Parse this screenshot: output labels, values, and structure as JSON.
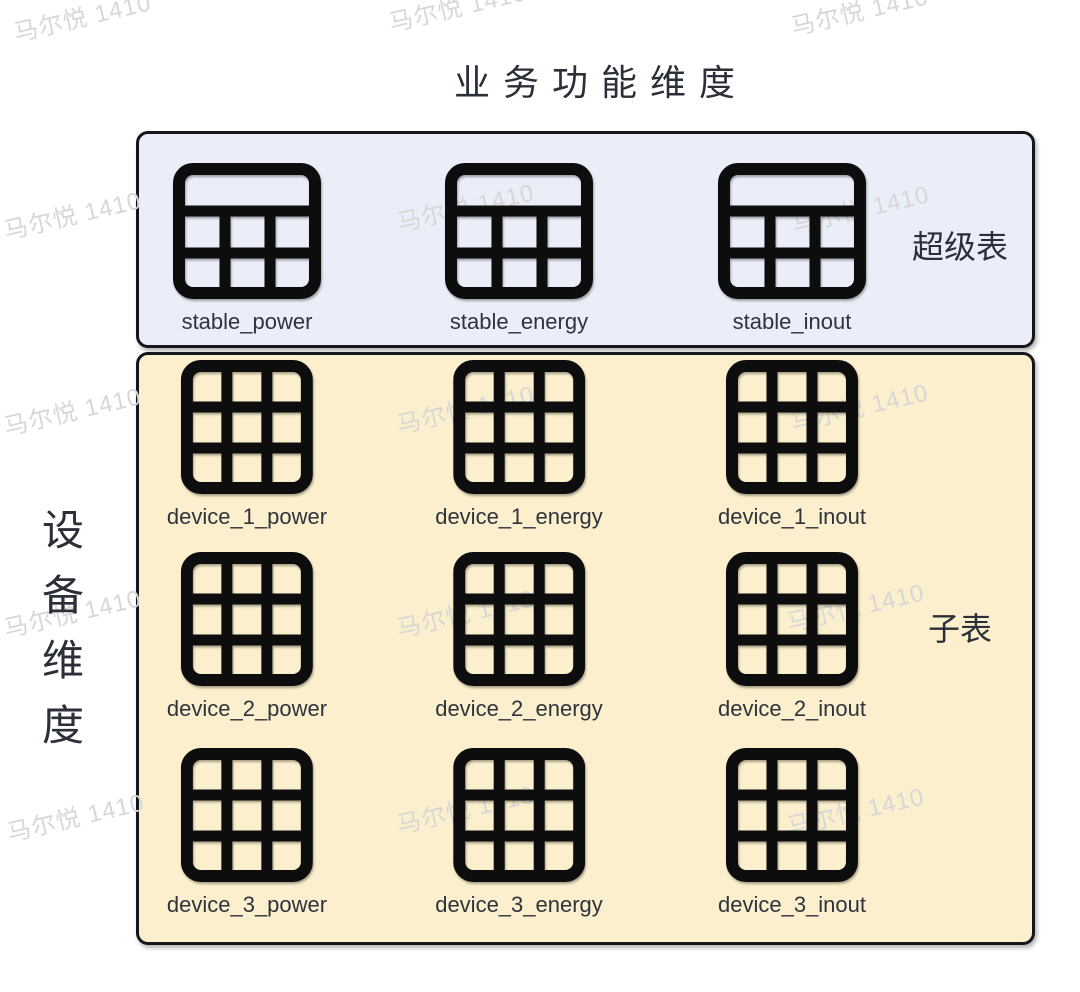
{
  "title": "业务功能维度",
  "vertical_axis_label": "设备维度",
  "watermark": {
    "text": "马尔悦 1410",
    "positions": [
      [
        10,
        14
      ],
      [
        385,
        4
      ],
      [
        787,
        8
      ],
      [
        0,
        212
      ],
      [
        393,
        204
      ],
      [
        788,
        206
      ],
      [
        0,
        408
      ],
      [
        393,
        406
      ],
      [
        787,
        404
      ],
      [
        0,
        610
      ],
      [
        393,
        610
      ],
      [
        783,
        604
      ],
      [
        3,
        814
      ],
      [
        393,
        806
      ],
      [
        783,
        808
      ]
    ]
  },
  "super_section": {
    "label": "超级表",
    "icon": "super-table-icon",
    "tables": [
      "stable_power",
      "stable_energy",
      "stable_inout"
    ]
  },
  "sub_section": {
    "label": "子表",
    "icon": "sub-table-icon",
    "rows": [
      [
        "device_1_power",
        "device_1_energy",
        "device_1_inout"
      ],
      [
        "device_2_power",
        "device_2_energy",
        "device_2_inout"
      ],
      [
        "device_3_power",
        "device_3_energy",
        "device_3_inout"
      ]
    ]
  },
  "colors": {
    "super_bg": "#eaeef9",
    "sub_bg": "#fbefcd",
    "border": "#15151c",
    "icon": "#0d0d0d",
    "text": "#2f333c",
    "heading": "#2b2f38",
    "watermark": "#d7d7d7"
  }
}
